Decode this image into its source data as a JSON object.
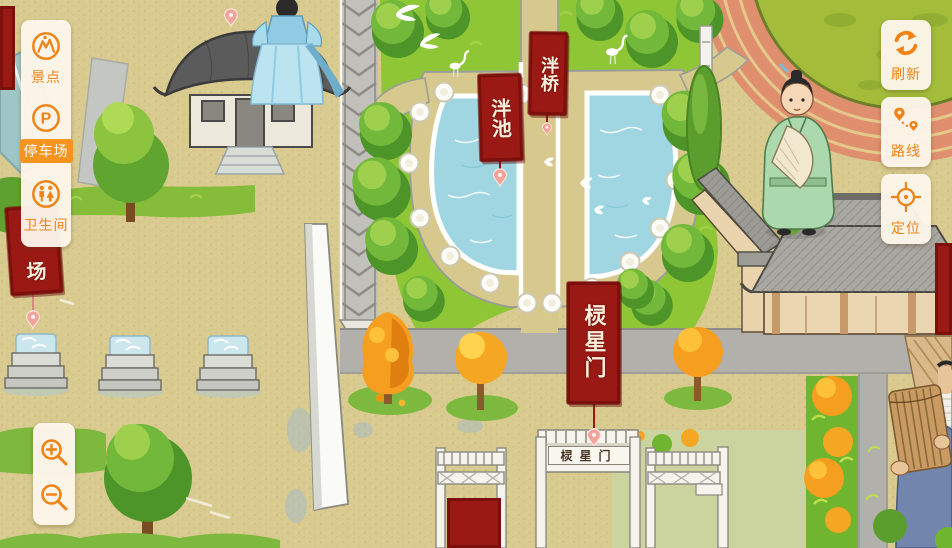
{
  "ui": {
    "sidebar": {
      "items": [
        {
          "id": "scenic",
          "label": "景点",
          "icon": "scenic-spot-icon",
          "active": false
        },
        {
          "id": "parking",
          "label": "停车场",
          "icon": "parking-icon",
          "glyph": "P",
          "active": true
        },
        {
          "id": "restroom",
          "label": "卫生间",
          "icon": "restroom-icon",
          "active": false
        }
      ]
    },
    "map_controls": [
      {
        "id": "refresh",
        "label": "刷新",
        "icon": "refresh-icon"
      },
      {
        "id": "route",
        "label": "路线",
        "icon": "route-icon"
      },
      {
        "id": "locate",
        "label": "定位",
        "icon": "locate-icon"
      }
    ],
    "zoom_controls": [
      {
        "id": "zoom-in",
        "icon": "zoom-in-icon"
      },
      {
        "id": "zoom-out",
        "icon": "zoom-out-icon"
      }
    ]
  },
  "map": {
    "labels": {
      "pond": "泮池",
      "bridge": "泮桥",
      "gate": "棂星门",
      "gate_plaque": "棂星门",
      "parking_partial": "场"
    }
  },
  "colors": {
    "accent_orange": "#F08216",
    "active_pill_orange": "#F79420",
    "panel_cream": "#FCF5E9",
    "banner_red": "#9B1914",
    "water_blue": "#9FD6E2",
    "ground_tan": "#D9CB90",
    "grass_green": "#8FC636",
    "road_grey": "#B2B0AB"
  }
}
